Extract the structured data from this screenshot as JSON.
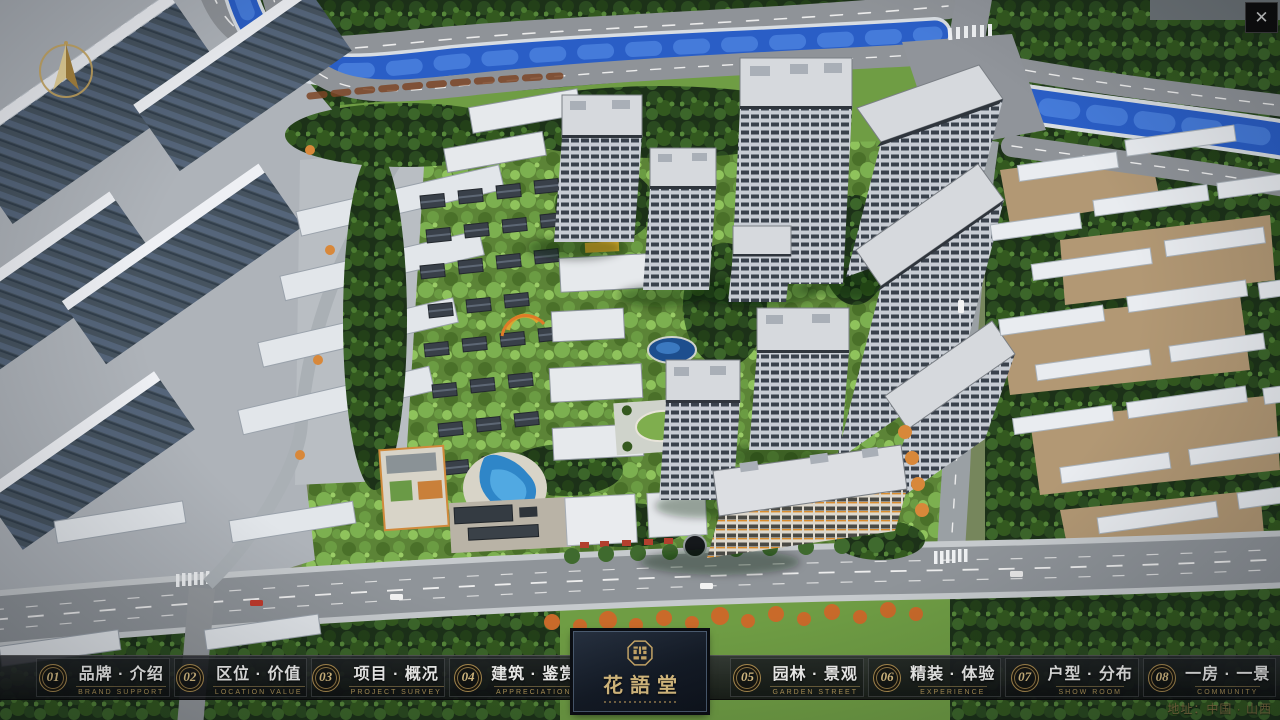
{
  "window": {
    "close_glyph": "✕"
  },
  "nav": {
    "items": [
      {
        "num": "01",
        "label": "品牌 · 介绍",
        "sub": "BRAND SUPPORT"
      },
      {
        "num": "02",
        "label": "区位 · 价值",
        "sub": "LOCATION VALUE"
      },
      {
        "num": "03",
        "label": "项目 · 概况",
        "sub": "PROJECT SURVEY"
      },
      {
        "num": "04",
        "label": "建筑 · 鉴赏",
        "sub": "APPRECIATION"
      },
      {
        "num": "05",
        "label": "园林 · 景观",
        "sub": "GARDEN STREET"
      },
      {
        "num": "06",
        "label": "精装 · 体验",
        "sub": "EXPERIENCE"
      },
      {
        "num": "07",
        "label": "户型 · 分布",
        "sub": "SHOW ROOM"
      },
      {
        "num": "08",
        "label": "一房 · 一景",
        "sub": "COMMUNITY"
      }
    ]
  },
  "logo": {
    "title": "花語堂"
  },
  "footer": {
    "address": "地址：中国 · 山西"
  },
  "colors": {
    "gold": "#c5a567",
    "river": "#2a5ec6",
    "bar_bg": "#141518"
  }
}
